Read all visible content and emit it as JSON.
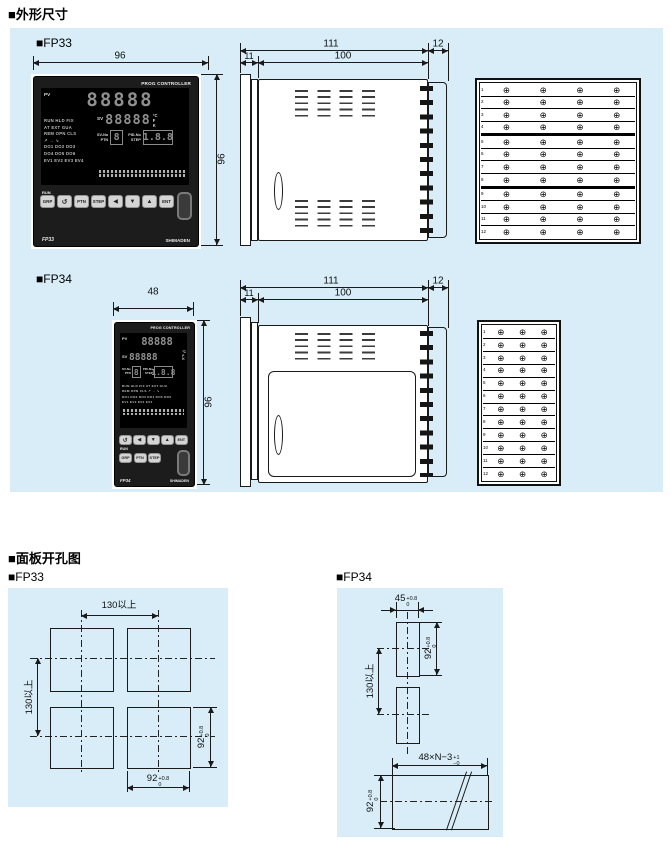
{
  "titles": {
    "dimensions": "■外形尺寸",
    "cutouts": "■面板开孔图"
  },
  "models": {
    "fp33": "■FP33",
    "fp34": "■FP34"
  },
  "colors": {
    "section_bg": "#d8edf7",
    "bezel": "#1c1c1c",
    "digit": "#8f8f8f",
    "line": "#1a1a1a"
  },
  "panel": {
    "brand": "PROG CONTROLLER",
    "pv": "PV",
    "sv": "SV",
    "pv_digits": "88888",
    "sv_digits": "88888",
    "units": [
      "°C",
      "F",
      "K"
    ],
    "status_rows": [
      "RUN HLD FIX",
      "AT EXT GUA",
      "REM OPN CLS",
      "↗ → ↘",
      "DO1 DO2 DO3",
      "DO4 DO5 DO6",
      "EV1 EV2 EV3 EV4"
    ],
    "status_rows34": [
      "RUN HLD FIX AT EXT GUA",
      "REM OPN CLS ↗ → ↘",
      "DO1 DO2 DO3 DO4 DO5 DO6",
      "EV1 EV2 EV3 EV4"
    ],
    "svno": "SV-No",
    "ptn": "PTN",
    "pidno": "PID-No",
    "step": "STEP",
    "ptn_digit": "8",
    "step_digits": "1.8.8",
    "run": "RUN",
    "buttons_fp33": [
      "GRP",
      "↺",
      "PTN",
      "STEP",
      "◀",
      "▼",
      "▲",
      "ENT"
    ],
    "buttons_fp34_row1": [
      "↺",
      "◀",
      "▼",
      "▲",
      "ENT"
    ],
    "buttons_fp34_row2": [
      "GRP",
      "PTN",
      "STEP"
    ],
    "model_fp33": "FP33",
    "model_fp34": "FP34",
    "maker": "SHIMADEN"
  },
  "fp33": {
    "front_w": "96",
    "front_h": "96",
    "side": {
      "total": "111",
      "flange": "11",
      "depth": "100",
      "cover": "12"
    },
    "rear": {
      "rows": 12,
      "cols": 4
    }
  },
  "fp34": {
    "front_w": "48",
    "front_h": "96",
    "side": {
      "total": "111",
      "flange": "11",
      "depth": "100",
      "cover": "12"
    },
    "rear": {
      "rows": 12,
      "cols": 3
    }
  },
  "cutout_fp33": {
    "h_pitch": "130以上",
    "v_pitch": "130以上",
    "w": {
      "v": "92",
      "p": "+0.8",
      "m": "0"
    },
    "h": {
      "v": "92",
      "p": "+0.8",
      "m": "0"
    }
  },
  "cutout_fp34": {
    "w": {
      "v": "45",
      "p": "+0.8",
      "m": "0"
    },
    "h": {
      "v": "92",
      "p": "+0.8",
      "m": "0"
    },
    "v_pitch": "130以上",
    "gw": {
      "v": "48×N−3",
      "p": "+1",
      "m": "−0"
    },
    "gh": {
      "v": "92",
      "p": "+0.8",
      "m": "0"
    }
  }
}
